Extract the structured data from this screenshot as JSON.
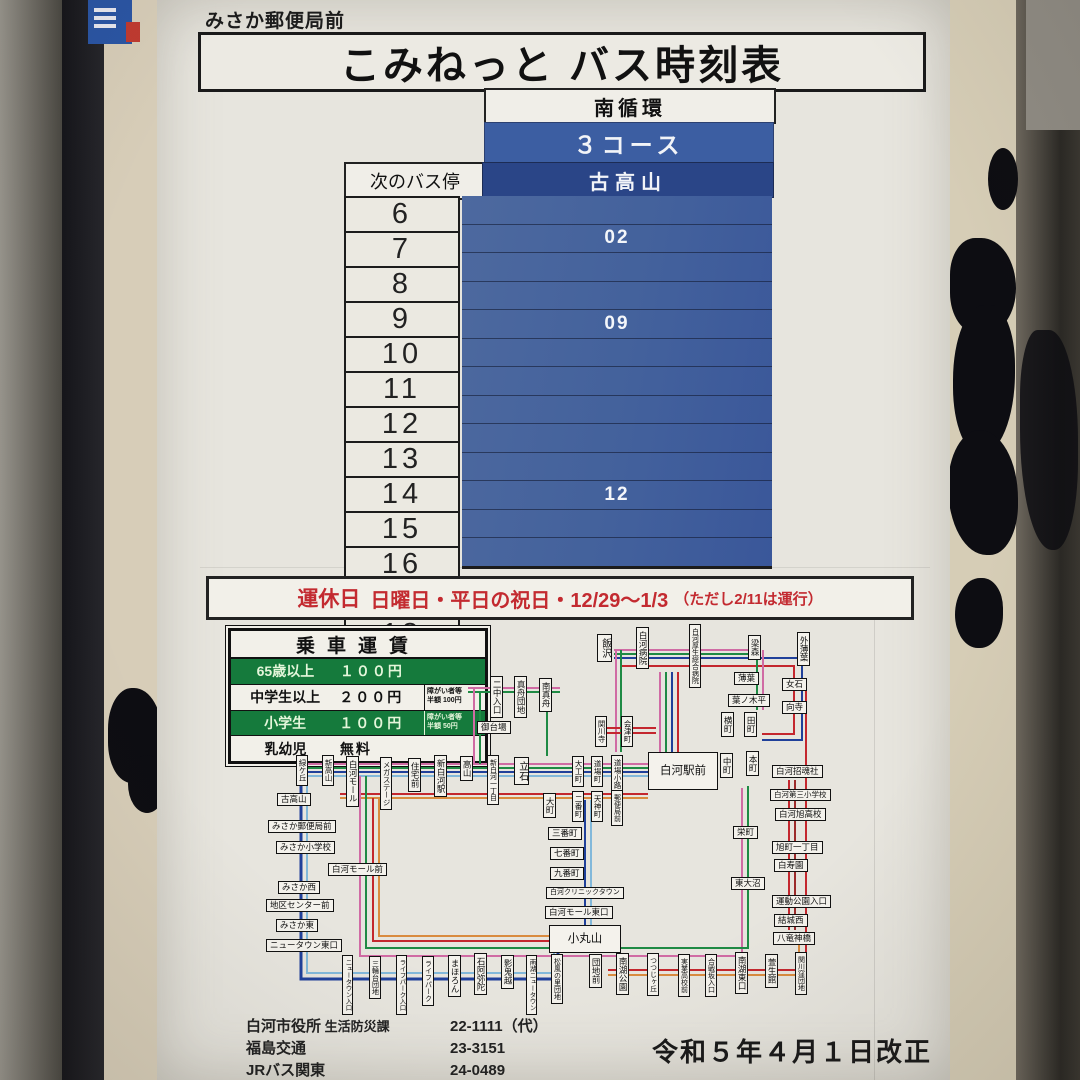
{
  "sign": {
    "bus_stop_name": "みさか郵便局前",
    "title": "こみねっと バス時刻表",
    "revision": "令和５年４月１日改正"
  },
  "timetable": {
    "route_group": "南循環",
    "course": "３コース",
    "next_stop_label": "次のバス停",
    "destination": "古高山",
    "rows": [
      {
        "hour": "6",
        "minutes": ""
      },
      {
        "hour": "7",
        "minutes": "02"
      },
      {
        "hour": "8",
        "minutes": ""
      },
      {
        "hour": "9",
        "minutes": ""
      },
      {
        "hour": "10",
        "minutes": "09"
      },
      {
        "hour": "11",
        "minutes": ""
      },
      {
        "hour": "12",
        "minutes": ""
      },
      {
        "hour": "13",
        "minutes": ""
      },
      {
        "hour": "14",
        "minutes": ""
      },
      {
        "hour": "15",
        "minutes": ""
      },
      {
        "hour": "16",
        "minutes": "12"
      },
      {
        "hour": "17",
        "minutes": ""
      },
      {
        "hour": "18",
        "minutes": ""
      }
    ]
  },
  "notice": {
    "label": "運休日",
    "text": "日曜日・平日の祝日・12/29～1/3",
    "paren": "（ただし2/11は運行）"
  },
  "fare": {
    "title": "乗車運賃",
    "rows": [
      {
        "label": "65歳以上",
        "price": "１００円",
        "note": "",
        "style": "green"
      },
      {
        "label": "中学生以上",
        "price": "２００円",
        "note": "障がい者等\n半額 100円",
        "style": "white"
      },
      {
        "label": "小学生",
        "price": "１００円",
        "note": "障がい者等\n半額 50円",
        "style": "green"
      },
      {
        "label": "乳幼児",
        "price": "無料",
        "note": "",
        "style": "white"
      }
    ]
  },
  "contacts": [
    {
      "name": "白河市役所",
      "dept": "生活防災課",
      "tel": "22-1111（代）"
    },
    {
      "name": "福島交通",
      "dept": "",
      "tel": "23-3151"
    },
    {
      "name": "JRバス関東",
      "dept": "",
      "tel": "24-0489"
    }
  ],
  "route_map": {
    "stops": [
      {
        "label": "二中入口",
        "x": 490,
        "y": 676,
        "o": "v"
      },
      {
        "label": "真舟団地",
        "x": 514,
        "y": 676,
        "o": "v"
      },
      {
        "label": "南真舟",
        "x": 539,
        "y": 678,
        "o": "v"
      },
      {
        "label": "御台場",
        "x": 477,
        "y": 721,
        "o": "h"
      },
      {
        "label": "飯沢",
        "x": 597,
        "y": 634,
        "o": "v",
        "fs": 10
      },
      {
        "label": "白河病院",
        "x": 636,
        "y": 627,
        "o": "v"
      },
      {
        "label": "白河厚生総合病院",
        "x": 689,
        "y": 624,
        "o": "v",
        "fs": 7
      },
      {
        "label": "梁森",
        "x": 748,
        "y": 635,
        "o": "v"
      },
      {
        "label": "外薄葉",
        "x": 797,
        "y": 632,
        "o": "v"
      },
      {
        "label": "薄葉",
        "x": 734,
        "y": 672,
        "o": "h"
      },
      {
        "label": "葉ノ木平",
        "x": 728,
        "y": 694,
        "o": "h"
      },
      {
        "label": "女石",
        "x": 782,
        "y": 678,
        "o": "h"
      },
      {
        "label": "向寺",
        "x": 782,
        "y": 701,
        "o": "h"
      },
      {
        "label": "関川寺",
        "x": 595,
        "y": 716,
        "o": "v",
        "fs": 7.5
      },
      {
        "label": "会津町",
        "x": 621,
        "y": 716,
        "o": "v",
        "fs": 7.5
      },
      {
        "label": "横町",
        "x": 721,
        "y": 712,
        "o": "v"
      },
      {
        "label": "田町",
        "x": 744,
        "y": 712,
        "o": "v"
      },
      {
        "label": "緑ケ丘",
        "x": 296,
        "y": 755,
        "o": "v",
        "fs": 7.5
      },
      {
        "label": "新高山",
        "x": 322,
        "y": 755,
        "o": "v",
        "fs": 7.5
      },
      {
        "label": "白河モール",
        "x": 346,
        "y": 756,
        "o": "v"
      },
      {
        "label": "メガステージ",
        "x": 380,
        "y": 757,
        "o": "v",
        "fs": 7.5
      },
      {
        "label": "住宅前",
        "x": 408,
        "y": 758,
        "o": "v"
      },
      {
        "label": "新白河駅",
        "x": 434,
        "y": 755,
        "o": "v"
      },
      {
        "label": "高山",
        "x": 460,
        "y": 756,
        "o": "v"
      },
      {
        "label": "新白河一丁目",
        "x": 487,
        "y": 755,
        "o": "v",
        "fs": 7
      },
      {
        "label": "立石",
        "x": 514,
        "y": 757,
        "o": "v",
        "fs": 10
      },
      {
        "label": "大工町",
        "x": 572,
        "y": 756,
        "o": "v",
        "fs": 7.5
      },
      {
        "label": "道場町",
        "x": 591,
        "y": 756,
        "o": "v",
        "fs": 7.5
      },
      {
        "label": "道場小路",
        "x": 611,
        "y": 755,
        "o": "v",
        "fs": 7.5
      },
      {
        "label": "白河駅前",
        "x": 648,
        "y": 752,
        "o": "h",
        "big": true,
        "w": 62,
        "h": 34
      },
      {
        "label": "中町",
        "x": 720,
        "y": 753,
        "o": "v"
      },
      {
        "label": "本町",
        "x": 746,
        "y": 751,
        "o": "v"
      },
      {
        "label": "大町",
        "x": 543,
        "y": 793,
        "o": "v"
      },
      {
        "label": "二番町",
        "x": 572,
        "y": 791,
        "o": "v",
        "fs": 7.5
      },
      {
        "label": "天神町",
        "x": 591,
        "y": 791,
        "o": "v",
        "fs": 7.5
      },
      {
        "label": "郵便局前",
        "x": 611,
        "y": 790,
        "o": "v",
        "fs": 7
      },
      {
        "label": "古高山",
        "x": 277,
        "y": 793,
        "o": "h"
      },
      {
        "label": "みさか郵便局前",
        "x": 268,
        "y": 820,
        "o": "h"
      },
      {
        "label": "みさか小学校",
        "x": 276,
        "y": 841,
        "o": "h"
      },
      {
        "label": "白河モール前",
        "x": 328,
        "y": 863,
        "o": "h"
      },
      {
        "label": "みさか西",
        "x": 278,
        "y": 881,
        "o": "h"
      },
      {
        "label": "地区センター前",
        "x": 266,
        "y": 899,
        "o": "h"
      },
      {
        "label": "みさか東",
        "x": 276,
        "y": 919,
        "o": "h"
      },
      {
        "label": "ニュータウン東口",
        "x": 266,
        "y": 939,
        "o": "h"
      },
      {
        "label": "三番町",
        "x": 548,
        "y": 827,
        "o": "h"
      },
      {
        "label": "七番町",
        "x": 550,
        "y": 847,
        "o": "h"
      },
      {
        "label": "九番町",
        "x": 550,
        "y": 867,
        "o": "h"
      },
      {
        "label": "白河クリニックタウン",
        "x": 546,
        "y": 887,
        "o": "h",
        "fs": 7
      },
      {
        "label": "白河モール東口",
        "x": 545,
        "y": 906,
        "o": "h"
      },
      {
        "label": "小丸山",
        "x": 549,
        "y": 925,
        "o": "h",
        "big": true,
        "w": 64,
        "h": 24
      },
      {
        "label": "白河招魂社",
        "x": 772,
        "y": 765,
        "o": "h"
      },
      {
        "label": "白河第三小学校",
        "x": 770,
        "y": 789,
        "o": "h",
        "fs": 7.5
      },
      {
        "label": "白河旭高校",
        "x": 775,
        "y": 808,
        "o": "h"
      },
      {
        "label": "栄町",
        "x": 733,
        "y": 826,
        "o": "h"
      },
      {
        "label": "旭町一丁目",
        "x": 772,
        "y": 841,
        "o": "h"
      },
      {
        "label": "白寿園",
        "x": 774,
        "y": 859,
        "o": "h"
      },
      {
        "label": "東大沼",
        "x": 731,
        "y": 877,
        "o": "h"
      },
      {
        "label": "運動公園入口",
        "x": 772,
        "y": 895,
        "o": "h"
      },
      {
        "label": "結城西",
        "x": 774,
        "y": 914,
        "o": "h"
      },
      {
        "label": "八竜神橋",
        "x": 773,
        "y": 932,
        "o": "h"
      },
      {
        "label": "ニュータウン入口",
        "x": 342,
        "y": 955,
        "o": "v",
        "fs": 6.5
      },
      {
        "label": "三輪台団地",
        "x": 369,
        "y": 956,
        "o": "v",
        "fs": 7
      },
      {
        "label": "ライフパーク入口",
        "x": 396,
        "y": 955,
        "o": "v",
        "fs": 6.5
      },
      {
        "label": "ライフパーク",
        "x": 422,
        "y": 956,
        "o": "v",
        "fs": 7
      },
      {
        "label": "まほろん",
        "x": 448,
        "y": 955,
        "o": "v"
      },
      {
        "label": "石阿弥陀",
        "x": 474,
        "y": 953,
        "o": "v"
      },
      {
        "label": "影鬼越",
        "x": 501,
        "y": 955,
        "o": "v"
      },
      {
        "label": "南湖ニュータウン",
        "x": 526,
        "y": 955,
        "o": "v",
        "fs": 6.5
      },
      {
        "label": "松風の里団地",
        "x": 551,
        "y": 954,
        "o": "v",
        "fs": 7
      },
      {
        "label": "団地前",
        "x": 589,
        "y": 954,
        "o": "v"
      },
      {
        "label": "南湖公園",
        "x": 616,
        "y": 953,
        "o": "v"
      },
      {
        "label": "つつじヶ丘",
        "x": 647,
        "y": 953,
        "o": "v",
        "fs": 7
      },
      {
        "label": "実業高校前",
        "x": 678,
        "y": 954,
        "o": "v",
        "fs": 7
      },
      {
        "label": "合戦坂入口",
        "x": 705,
        "y": 954,
        "o": "v",
        "fs": 7
      },
      {
        "label": "南湖東口",
        "x": 735,
        "y": 952,
        "o": "v"
      },
      {
        "label": "萱生館",
        "x": 765,
        "y": 954,
        "o": "v"
      },
      {
        "label": "関川窪団地",
        "x": 795,
        "y": 952,
        "o": "v",
        "fs": 7
      }
    ],
    "lines": [
      {
        "c": "#d06ba4",
        "p": [
          [
            298,
            764
          ],
          [
            650,
            764
          ]
        ]
      },
      {
        "c": "#1f8a44",
        "p": [
          [
            298,
            768
          ],
          [
            650,
            768
          ]
        ]
      },
      {
        "c": "#20409a",
        "p": [
          [
            298,
            772
          ],
          [
            650,
            772
          ]
        ]
      },
      {
        "c": "#82b8da",
        "p": [
          [
            298,
            776
          ],
          [
            650,
            776
          ]
        ]
      },
      {
        "c": "#c4272e",
        "p": [
          [
            340,
            794
          ],
          [
            648,
            794
          ]
        ]
      },
      {
        "c": "#d98b3f",
        "p": [
          [
            340,
            798
          ],
          [
            648,
            798
          ]
        ]
      },
      {
        "c": "#20409a",
        "w": 3,
        "p": [
          [
            301,
            776
          ],
          [
            301,
            979
          ],
          [
            558,
            979
          ],
          [
            558,
            948
          ]
        ]
      },
      {
        "c": "#82b8da",
        "p": [
          [
            307,
            776
          ],
          [
            307,
            973
          ],
          [
            554,
            973
          ],
          [
            554,
            948
          ]
        ]
      },
      {
        "c": "#d06ba4",
        "p": [
          [
            360,
            776
          ],
          [
            360,
            956
          ],
          [
            742,
            956
          ],
          [
            742,
            788
          ]
        ]
      },
      {
        "c": "#1f8a44",
        "p": [
          [
            366,
            776
          ],
          [
            366,
            948
          ],
          [
            748,
            948
          ],
          [
            748,
            786
          ]
        ]
      },
      {
        "c": "#c4272e",
        "p": [
          [
            373,
            798
          ],
          [
            373,
            941
          ],
          [
            552,
            941
          ]
        ]
      },
      {
        "c": "#d98b3f",
        "p": [
          [
            379,
            798
          ],
          [
            379,
            936
          ],
          [
            552,
            936
          ]
        ]
      },
      {
        "c": "#c4272e",
        "p": [
          [
            608,
            970
          ],
          [
            806,
            970
          ],
          [
            806,
            688
          ]
        ]
      },
      {
        "c": "#d98b3f",
        "p": [
          [
            608,
            975
          ],
          [
            799,
            975
          ],
          [
            799,
            938
          ]
        ]
      },
      {
        "c": "#20409a",
        "p": [
          [
            585,
            800
          ],
          [
            585,
            928
          ]
        ]
      },
      {
        "c": "#82b8da",
        "p": [
          [
            591,
            800
          ],
          [
            591,
            928
          ]
        ]
      },
      {
        "c": "#d06ba4",
        "p": [
          [
            660,
            752
          ],
          [
            660,
            672
          ]
        ]
      },
      {
        "c": "#1f8a44",
        "p": [
          [
            666,
            752
          ],
          [
            666,
            672
          ]
        ]
      },
      {
        "c": "#20409a",
        "p": [
          [
            672,
            752
          ],
          [
            672,
            672
          ]
        ]
      },
      {
        "c": "#c4272e",
        "p": [
          [
            678,
            752
          ],
          [
            678,
            672
          ]
        ]
      },
      {
        "c": "#d06ba4",
        "p": [
          [
            614,
            650
          ],
          [
            754,
            650
          ]
        ]
      },
      {
        "c": "#1f8a44",
        "p": [
          [
            614,
            654
          ],
          [
            754,
            654
          ]
        ]
      },
      {
        "c": "#20409a",
        "p": [
          [
            614,
            658
          ],
          [
            802,
            658
          ],
          [
            802,
            740
          ],
          [
            762,
            740
          ]
        ]
      },
      {
        "c": "#c4272e",
        "p": [
          [
            622,
            666
          ],
          [
            794,
            666
          ],
          [
            794,
            734
          ],
          [
            762,
            734
          ]
        ]
      },
      {
        "c": "#d06ba4",
        "p": [
          [
            616,
            650
          ],
          [
            616,
            752
          ]
        ]
      },
      {
        "c": "#1f8a44",
        "p": [
          [
            621,
            650
          ],
          [
            621,
            752
          ]
        ]
      },
      {
        "c": "#1f8a44",
        "p": [
          [
            757,
            654
          ],
          [
            757,
            710
          ]
        ]
      },
      {
        "c": "#d06ba4",
        "p": [
          [
            763,
            650
          ],
          [
            763,
            710
          ]
        ]
      },
      {
        "c": "#c4272e",
        "p": [
          [
            600,
            728
          ],
          [
            656,
            728
          ]
        ]
      },
      {
        "c": "#c4272e",
        "p": [
          [
            600,
            733
          ],
          [
            656,
            733
          ]
        ]
      },
      {
        "c": "#d06ba4",
        "p": [
          [
            468,
            688
          ],
          [
            560,
            688
          ]
        ]
      },
      {
        "c": "#1f8a44",
        "p": [
          [
            468,
            692
          ],
          [
            560,
            692
          ]
        ]
      },
      {
        "c": "#1f8a44",
        "p": [
          [
            547,
            692
          ],
          [
            547,
            756
          ]
        ]
      },
      {
        "c": "#d06ba4",
        "p": [
          [
            474,
            688
          ],
          [
            474,
            764
          ]
        ]
      },
      {
        "c": "#1f8a44",
        "p": [
          [
            480,
            692
          ],
          [
            480,
            764
          ]
        ]
      },
      {
        "c": "#9c2b2b",
        "p": [
          [
            795,
            780
          ],
          [
            795,
            930
          ]
        ]
      },
      {
        "c": "#c4272e",
        "p": [
          [
            789,
            780
          ],
          [
            789,
            930
          ]
        ]
      }
    ]
  }
}
